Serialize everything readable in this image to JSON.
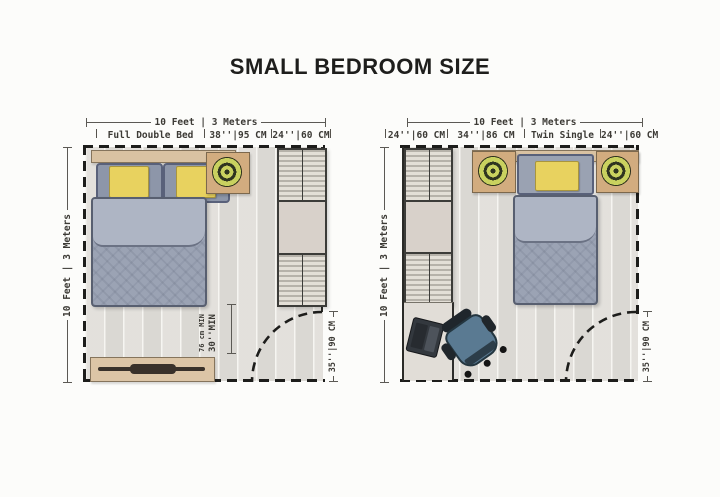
{
  "title": "SMALL BEDROOM SIZE",
  "left_plan": {
    "top_dimension": "10 Feet | 3 Meters",
    "side_dimension": "10 Feet | 3 Meters",
    "segment_labels": [
      "Full Double Bed",
      "38''|95 CM",
      "24''|60 CM"
    ],
    "clearance_metric": "76 cm MIN",
    "clearance_imperial": "30''MIN",
    "door_width": "35''|90 CM"
  },
  "right_plan": {
    "top_dimension": "10 Feet | 3 Meters",
    "side_dimension": "10 Feet | 3 Meters",
    "segment_labels": [
      "24''|60 CM",
      "34''|86 CM",
      "Twin Single",
      "24''|60 CM"
    ],
    "door_width": "35''|90 CM"
  },
  "colors": {
    "wall": "#1d1d1b",
    "wood": "#d9c2a2",
    "cushion_yellow": "#e8d25f",
    "duvet_gray_blue": "#9ba3b4",
    "plant_green": "#c9d15f",
    "chair_teal": "#5a7a92",
    "floor": "#ebe9e5",
    "label_text": "#3c3a35"
  }
}
